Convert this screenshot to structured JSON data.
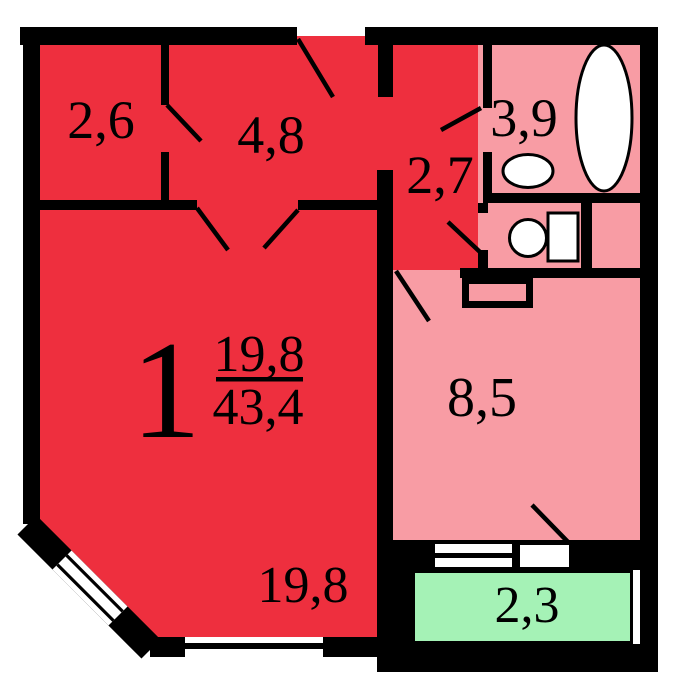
{
  "plan": {
    "type": "apartment-floor-plan",
    "rooms": {
      "storage": {
        "area": "2,6"
      },
      "hallway": {
        "area": "4,8"
      },
      "bathroom": {
        "area": "3,9"
      },
      "corridor": {
        "area": "2,7"
      },
      "living_room": {
        "number": "1",
        "area_living": "19,8",
        "area_total": "43,4",
        "area_label": "19,8"
      },
      "kitchen": {
        "area": "8,5"
      },
      "balcony": {
        "area": "2,3"
      }
    },
    "fixtures": [
      "bathtub",
      "sink",
      "toilet",
      "washing-machine",
      "vent-shaft"
    ],
    "colors": {
      "room_red": "#EE2F3E",
      "wet_pink": "#F89CA4",
      "balcony_green": "#A5F2B6",
      "wall_black": "#000000",
      "background": "#FFFFFF"
    }
  }
}
